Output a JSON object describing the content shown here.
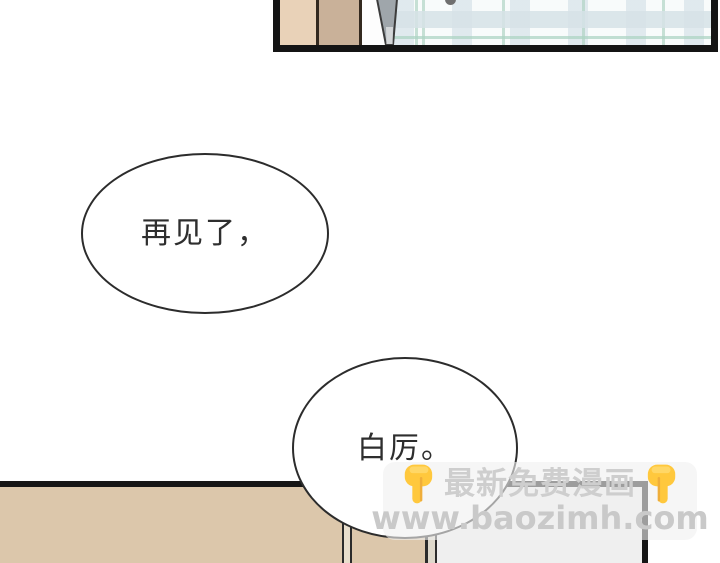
{
  "comic": {
    "bubbles": [
      {
        "text": "再见了，"
      },
      {
        "text": "白厉。"
      }
    ]
  },
  "watermark": {
    "title": "最新免费漫画",
    "url": "www.baozimh.com",
    "left_icon": "finger-down-icon",
    "right_icon": "finger-down-icon"
  },
  "colors": {
    "panel_border": "#141414",
    "wardrobe_light": "#e9d2b8",
    "wardrobe_dark": "#c9b199",
    "plaid_blue": "#dee7ec",
    "plaid_teal": "#b1d4c5",
    "wall_tan": "#dcc7ab",
    "door_white": "#efefef",
    "bubble_outline": "#2c2c2c",
    "watermark_text": "#cecece",
    "finger_yellow": "#ffc83d"
  }
}
